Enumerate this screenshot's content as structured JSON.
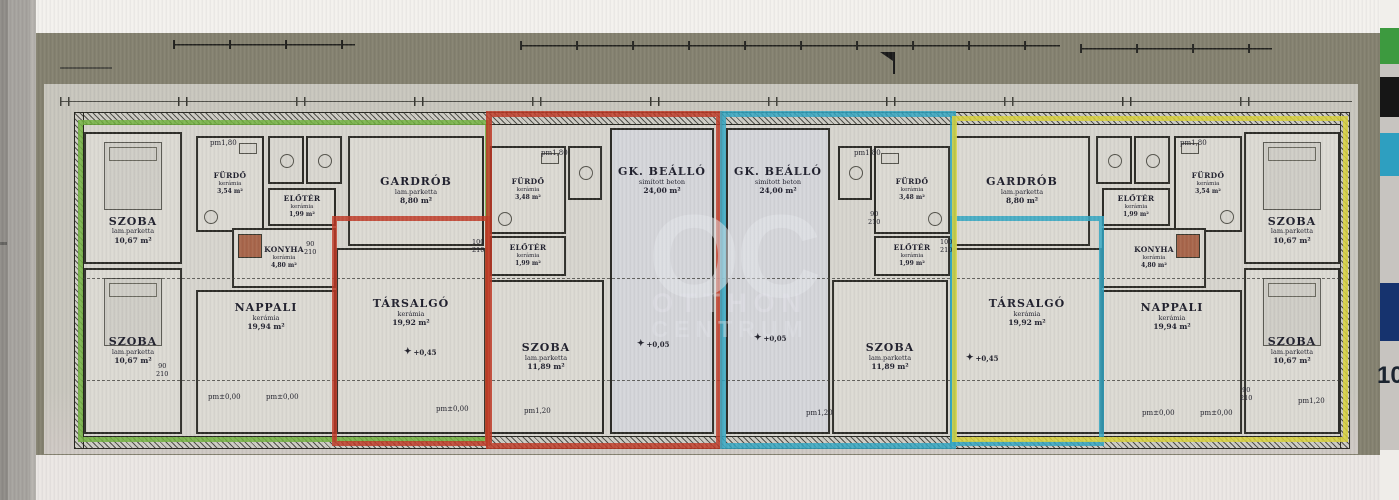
{
  "watermark": {
    "initials": "OC",
    "line1": "OTTHON",
    "line2": "CENTRUM"
  },
  "sidebar": {
    "page_number": "10"
  },
  "colors": {
    "unit_left_outline": "#72b33e",
    "unit_midleft_outline": "#bf3a26",
    "unit_midright_outline": "#31a6c2",
    "unit_right_outline": "#d9d23a"
  },
  "rooms": [
    {
      "name": "SZOBA",
      "floor": "lam.parketta",
      "area": "10,67 m²"
    },
    {
      "name": "SZOBA",
      "floor": "lam.parketta",
      "area": "10,67 m²"
    },
    {
      "name": "FÜRDŐ",
      "floor": "kerámia",
      "area": "3,54 m²"
    },
    {
      "name": "ELŐTÉR",
      "floor": "kerámia",
      "area": "1,99 m²"
    },
    {
      "name": "KONYHA",
      "floor": "kerámia",
      "area": "4,80 m²"
    },
    {
      "name": "NAPPALI",
      "floor": "kerámia",
      "area": "19,94 m²"
    },
    {
      "name": "GARDRÓB",
      "floor": "lam.parketta",
      "area": "8,80 m²"
    },
    {
      "name": "TÁRSALGÓ",
      "floor": "kerámia",
      "area": "19,92 m²"
    },
    {
      "name": "FÜRDŐ",
      "floor": "kerámia",
      "area": "3,48 m²"
    },
    {
      "name": "ELŐTÉR",
      "floor": "kerámia",
      "area": "1,99 m²"
    },
    {
      "name": "SZOBA",
      "floor": "lam.parketta",
      "area": "11,89 m²"
    },
    {
      "name": "GK. BEÁLLÓ",
      "floor": "simított beton",
      "area": "24,00 m²"
    },
    {
      "name": "GK. BEÁLLÓ",
      "floor": "simított beton",
      "area": "24,00 m²"
    },
    {
      "name": "SZOBA",
      "floor": "lam.parketta",
      "area": "11,89 m²"
    },
    {
      "name": "FÜRDŐ",
      "floor": "kerámia",
      "area": "3,48 m²"
    },
    {
      "name": "ELŐTÉR",
      "floor": "kerámia",
      "area": "1,99 m²"
    },
    {
      "name": "TÁRSALGÓ",
      "floor": "kerámia",
      "area": "19,92 m²"
    },
    {
      "name": "GARDRÓB",
      "floor": "lam.parketta",
      "area": "8,80 m²"
    },
    {
      "name": "ELŐTÉR",
      "floor": "kerámia",
      "area": "1,99 m²"
    },
    {
      "name": "FÜRDŐ",
      "floor": "kerámia",
      "area": "3,54 m²"
    },
    {
      "name": "KONYHA",
      "floor": "kerámia",
      "area": "4,80 m²"
    },
    {
      "name": "NAPPALI",
      "floor": "kerámia",
      "area": "19,94 m²"
    },
    {
      "name": "SZOBA",
      "floor": "lam.parketta",
      "area": "10,67 m²"
    },
    {
      "name": "SZOBA",
      "floor": "lam.parketta",
      "area": "10,67 m²"
    }
  ],
  "labels": {
    "pm180": "pm1,80",
    "pm000": "pm±0,00",
    "pm120": "pm1,20",
    "lvl045": "+0,45",
    "lvl005": "+0,05",
    "diamond": "✦",
    "door90": "90",
    "door100": "100",
    "door210": "210"
  }
}
